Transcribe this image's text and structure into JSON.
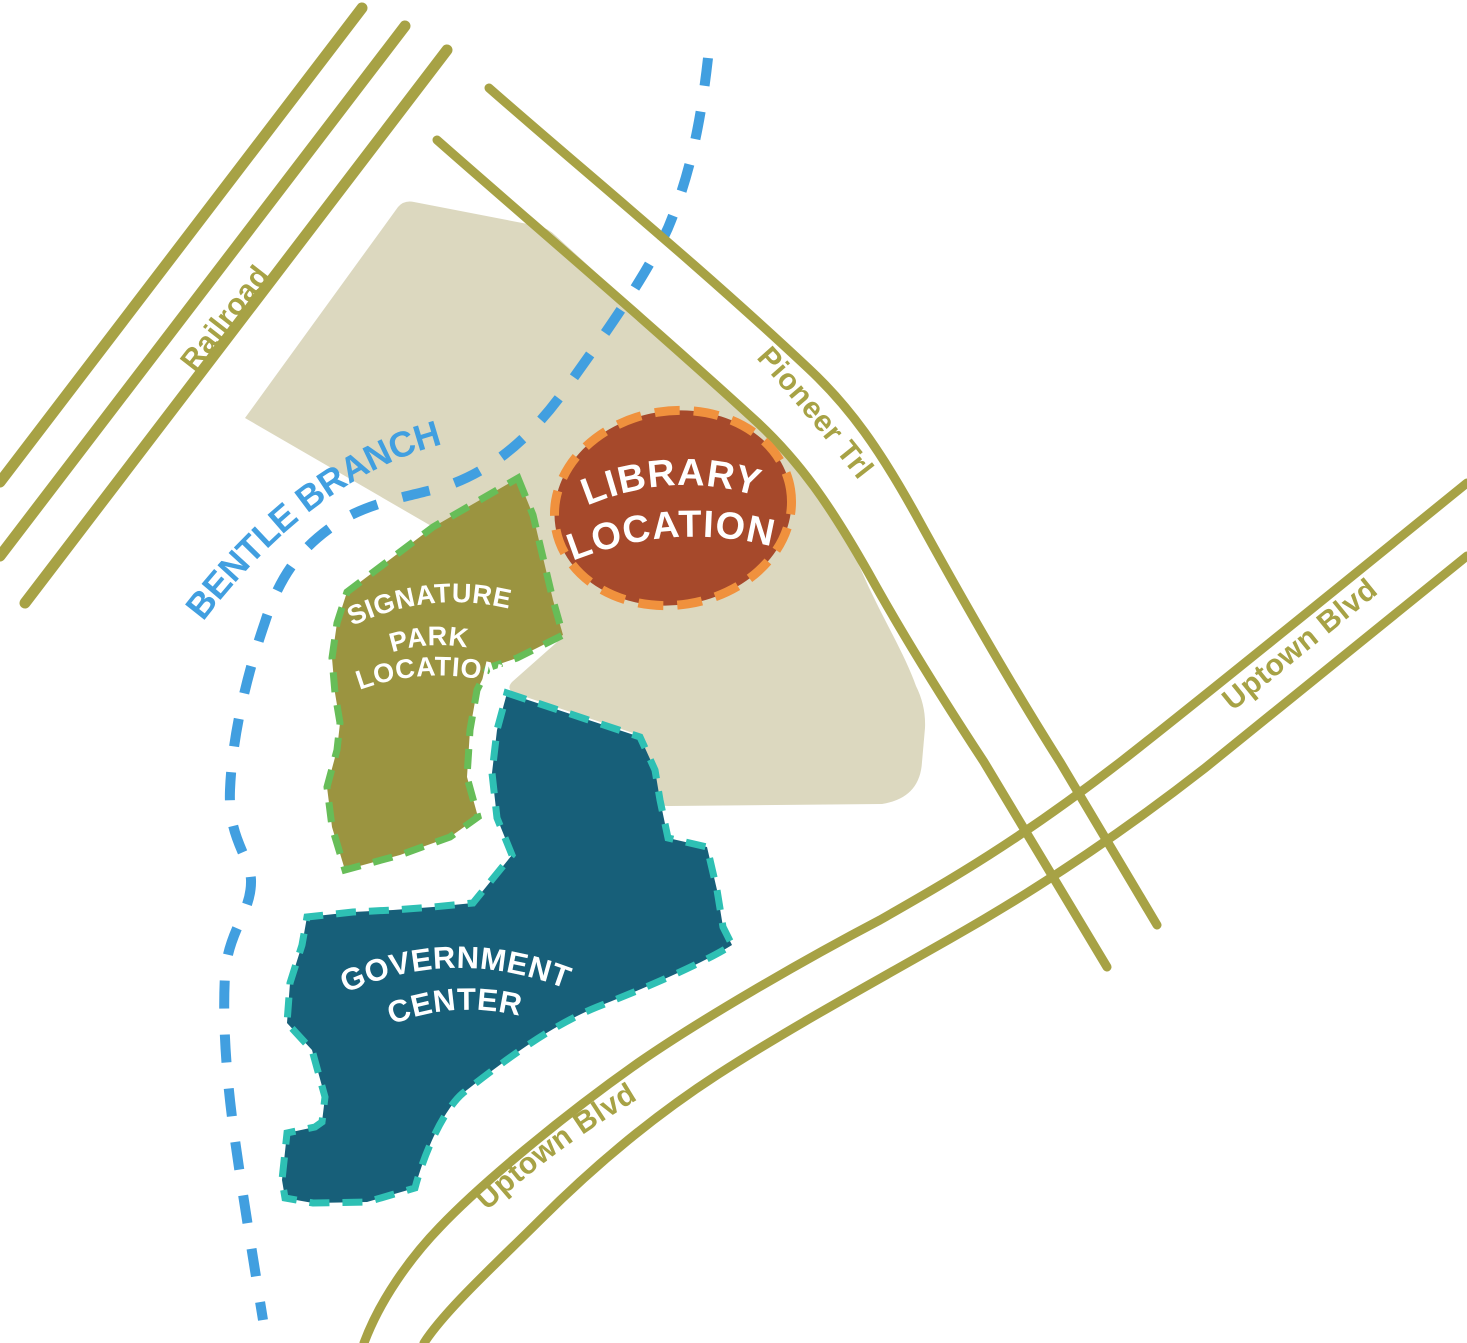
{
  "title": "Library, Signature Park and Government Center location map",
  "map": {
    "background": "#ffffff",
    "colors": {
      "road": "#a7a245",
      "site_area": "#dcd8bf",
      "creek": "#419fe0",
      "library_fill": "#a6492b",
      "library_border": "#f0913d",
      "park_fill": "#9b9440",
      "park_border": "#67bd58",
      "government_fill": "#175f79",
      "government_border": "#2ec0b4",
      "site_label_text": "#ffffff"
    },
    "roads": {
      "railroad_label": "Railroad",
      "pioneer_label": "Pioneer Trl",
      "uptown_right_label": "Uptown Blvd",
      "uptown_bottom_label": "Uptown Blvd"
    },
    "creek": {
      "label": "BENTLE BRANCH"
    },
    "sites": {
      "library": {
        "line1": "LIBRARY",
        "line2": "LOCATION"
      },
      "park": {
        "line1": "SIGNATURE",
        "line2": "PARK",
        "line3": "LOCATION"
      },
      "government": {
        "line1": "GOVERNMENT",
        "line2": "CENTER"
      }
    }
  }
}
